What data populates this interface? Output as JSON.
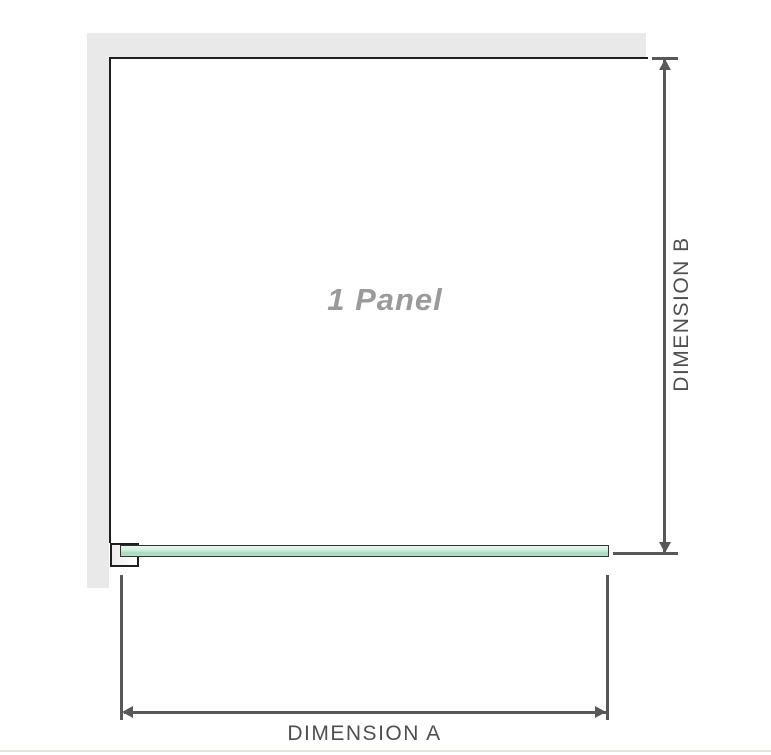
{
  "diagram": {
    "title": "1 panel shower screen dimension diagram",
    "panel_label": "1 Panel",
    "dimension_a": {
      "label": "DIMENSION A",
      "measures": "glass panel width"
    },
    "dimension_b": {
      "label": "DIMENSION B",
      "measures": "glass panel height"
    },
    "colors": {
      "wall_gray": "#e9e9e9",
      "panel_outline": "#1f1f1f",
      "dimension_line": "#58585a",
      "dimension_label_text": "#4f4f4f",
      "panel_label_text": "#9a9a9a",
      "glass_green_light": "#eaf7ef",
      "glass_green_dark": "#a9dbbe",
      "glass_border": "#333333",
      "bottom_divider": "#e6e4dd"
    }
  }
}
